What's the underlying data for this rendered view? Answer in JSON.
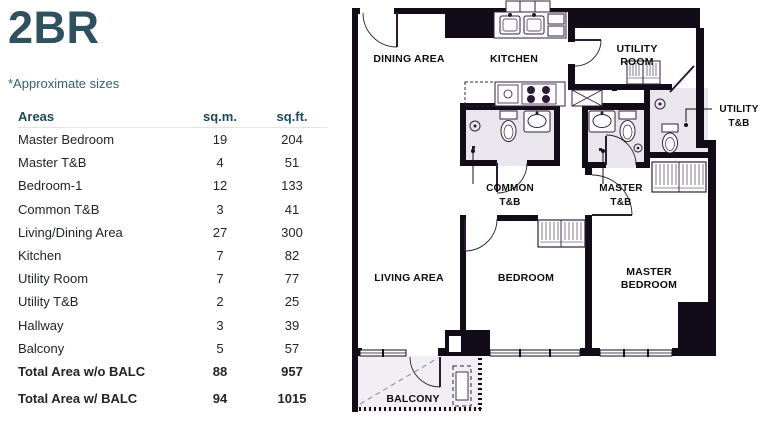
{
  "title": "2BR",
  "note": "*Approximate sizes",
  "table": {
    "headers": {
      "areas": "Areas",
      "sqm": "sq.m.",
      "sqft": "sq.ft."
    },
    "rows": [
      {
        "label": "Master Bedroom",
        "sqm": "19",
        "sqft": "204",
        "bold": false
      },
      {
        "label": "Master T&B",
        "sqm": "4",
        "sqft": "51",
        "bold": false
      },
      {
        "label": "Bedroom-1",
        "sqm": "12",
        "sqft": "133",
        "bold": false
      },
      {
        "label": "Common T&B",
        "sqm": "3",
        "sqft": "41",
        "bold": false
      },
      {
        "label": "Living/Dining Area",
        "sqm": "27",
        "sqft": "300",
        "bold": false
      },
      {
        "label": "Kitchen",
        "sqm": "7",
        "sqft": "82",
        "bold": false
      },
      {
        "label": "Utility Room",
        "sqm": "7",
        "sqft": "77",
        "bold": false
      },
      {
        "label": "Utility T&B",
        "sqm": "2",
        "sqft": "25",
        "bold": false
      },
      {
        "label": "Hallway",
        "sqm": "3",
        "sqft": "39",
        "bold": false
      },
      {
        "label": "Balcony",
        "sqm": "5",
        "sqft": "57",
        "bold": false
      },
      {
        "label": "Total Area w/o BALC",
        "sqm": "88",
        "sqft": "957",
        "bold": true
      },
      {
        "label": "Total Area w/ BALC",
        "sqm": "94",
        "sqft": "1015",
        "bold": true
      }
    ]
  },
  "floorplan": {
    "rooms": {
      "dining": "DINING AREA",
      "kitchen": "KITCHEN",
      "utility_room_line1": "UTILITY",
      "utility_room_line2": "ROOM",
      "utility_tb_line1": "UTILITY",
      "utility_tb_line2": "T&B",
      "common_tb_line1": "COMMON",
      "common_tb_line2": "T&B",
      "master_tb_line1": "MASTER",
      "master_tb_line2": "T&B",
      "living": "LIVING AREA",
      "bedroom": "BEDROOM",
      "master_line1": "MASTER",
      "master_line2": "BEDROOM",
      "balcony": "BALCONY"
    },
    "colors": {
      "wall": "#120c19",
      "fixture": "#33203c",
      "bath_floor": "#eae6ed",
      "label": "#0d0d0f"
    }
  },
  "colors": {
    "accent_teal": "#2e505f",
    "header_teal": "#1d4a5c",
    "text_dark": "#20242b"
  }
}
